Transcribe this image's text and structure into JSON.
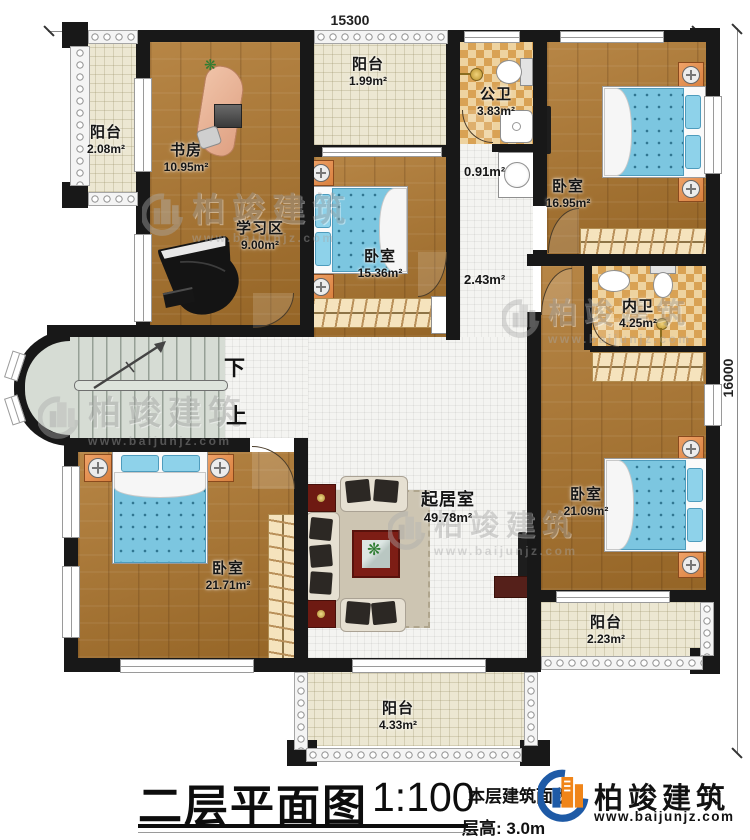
{
  "dimensions": {
    "top": "15300",
    "right": "16000"
  },
  "stairs": {
    "down": "下",
    "up": "上"
  },
  "rooms": {
    "balcony_left": {
      "label": "阳台",
      "area": "2.08m²"
    },
    "study": {
      "label": "书房",
      "area": "10.95m²"
    },
    "study_area": {
      "label": "学习区",
      "area": "9.00m²"
    },
    "balcony_top": {
      "label": "阳台",
      "area": "1.99m²"
    },
    "bedroom_mid": {
      "label": "卧室",
      "area": "15.36m²"
    },
    "public_bath": {
      "label": "公卫",
      "area": "3.83m²"
    },
    "wash_area": {
      "area": "0.91m²"
    },
    "hallway": {
      "area": "2.43m²"
    },
    "bedroom_topright": {
      "label": "卧室",
      "area": "16.95m²"
    },
    "inner_bath": {
      "label": "内卫",
      "area": "4.25m²"
    },
    "bedroom_right": {
      "label": "卧室",
      "area": "21.09m²"
    },
    "balcony_right": {
      "label": "阳台",
      "area": "2.23m²"
    },
    "living_room": {
      "label": "起居室",
      "area": "49.78m²"
    },
    "bedroom_bottomleft": {
      "label": "卧室",
      "area": "21.71m²"
    },
    "balcony_bottom": {
      "label": "阳台",
      "area": "4.33m²"
    }
  },
  "title_block": {
    "title": "二层平面图",
    "scale": "1:100",
    "area_note": "本层建筑面积",
    "floor_height": "层高: 3.0m"
  },
  "brand": {
    "name": "柏竣建筑",
    "website": "www.baijunjz.com"
  },
  "watermark": {
    "name": "柏竣建筑",
    "website": "www.baijunjz.com"
  },
  "colors": {
    "brand_blue": "#1e5aa6",
    "brand_orange": "#f08519",
    "wall": "#181818"
  }
}
